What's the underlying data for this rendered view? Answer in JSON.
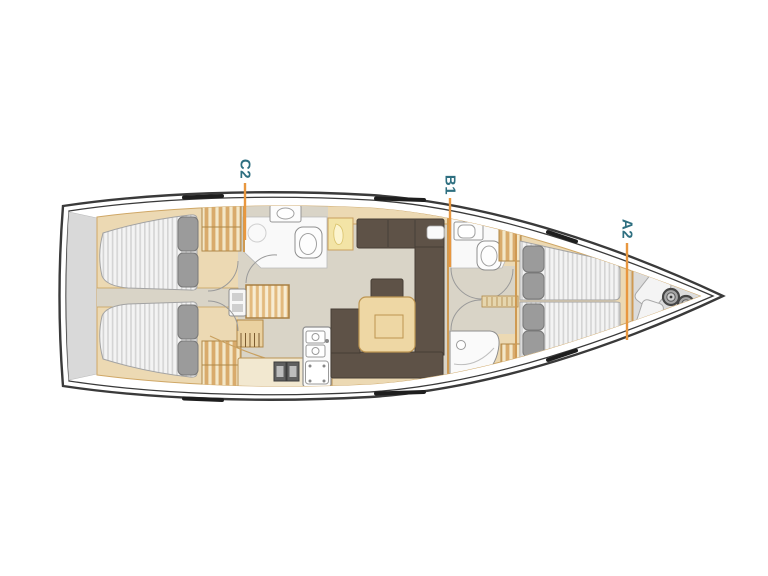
{
  "diagram": {
    "kind": "sailing-yacht-interior-layout-plan",
    "labels": {
      "c2": "C2",
      "b1": "B1",
      "a2": "A2"
    },
    "colors": {
      "background": "#ffffff",
      "label_text": "#2e6f80",
      "leader_line": "#e8973f",
      "hull_outline": "#3a3a3a",
      "interior_wood": "#ecd9b3",
      "wood_trim": "#cf9a52",
      "floor": "#d9d4c7",
      "sofa_brown": "#5e5247",
      "table_wood": "#eed7a4",
      "mattress": "#f3f3f3",
      "pillow": "#9b9b9b",
      "deck_gray": "#d9d9d9"
    }
  }
}
